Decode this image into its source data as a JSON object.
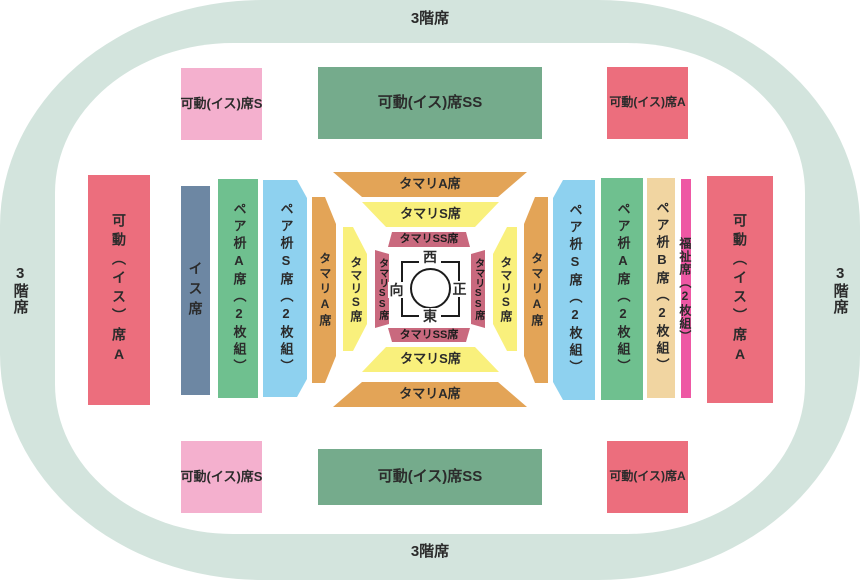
{
  "colors": {
    "outer_band": "#d3e4dd",
    "movable_a_red": "#ec6e7d",
    "movable_s_pink": "#f4b0ce",
    "movable_ss_green": "#75ab8c",
    "isu_blue": "#6d87a3",
    "pair_a_green": "#6fc08f",
    "pair_s_blue": "#8ed1ef",
    "pair_b_tan": "#f1d5a1",
    "fukushi_magenta": "#ee58a4",
    "tamari_a_orange": "#e3a457",
    "tamari_s_yellow": "#f9f07c",
    "tamari_ss_rose": "#c9697e",
    "ink": "#2b2b2b"
  },
  "floor3": {
    "top": "3階席",
    "bottom": "3階席",
    "left": "3階席",
    "right": "3階席"
  },
  "movable": {
    "s_top": "可動(イス)席S",
    "ss_top": "可動(イス)席SS",
    "a_top": "可動(イス)席A",
    "s_bottom": "可動(イス)席S",
    "ss_bottom": "可動(イス)席SS",
    "a_bottom": "可動(イス)席A",
    "a_left": "可動(イス)席A",
    "a_right": "可動(イス)席A"
  },
  "boxes": {
    "isu": "イス席",
    "pair_a_left": "ペア枡A席(2枚組)",
    "pair_s_left": "ペア枡S席(2枚組)",
    "pair_s_right": "ペア枡S席(2枚組)",
    "pair_a_right": "ペア枡A席(2枚組)",
    "pair_b_right": "ペア枡B席(2枚組)",
    "fukushi_right": "福祉席(2枚組)"
  },
  "tamari": {
    "a_top": "タマリA席",
    "a_bottom": "タマリA席",
    "a_left": "タマリA席",
    "a_right": "タマリA席",
    "s_top": "タマリS席",
    "s_bottom": "タマリS席",
    "s_left": "タマリS席",
    "s_right": "タマリS席",
    "ss_top": "タマリSS席",
    "ss_bottom": "タマリSS席",
    "ss_left": "タマリSS席",
    "ss_right": "タマリSS席"
  },
  "dohyo": {
    "west": "西",
    "east": "東",
    "front": "正",
    "opposite": "向"
  }
}
